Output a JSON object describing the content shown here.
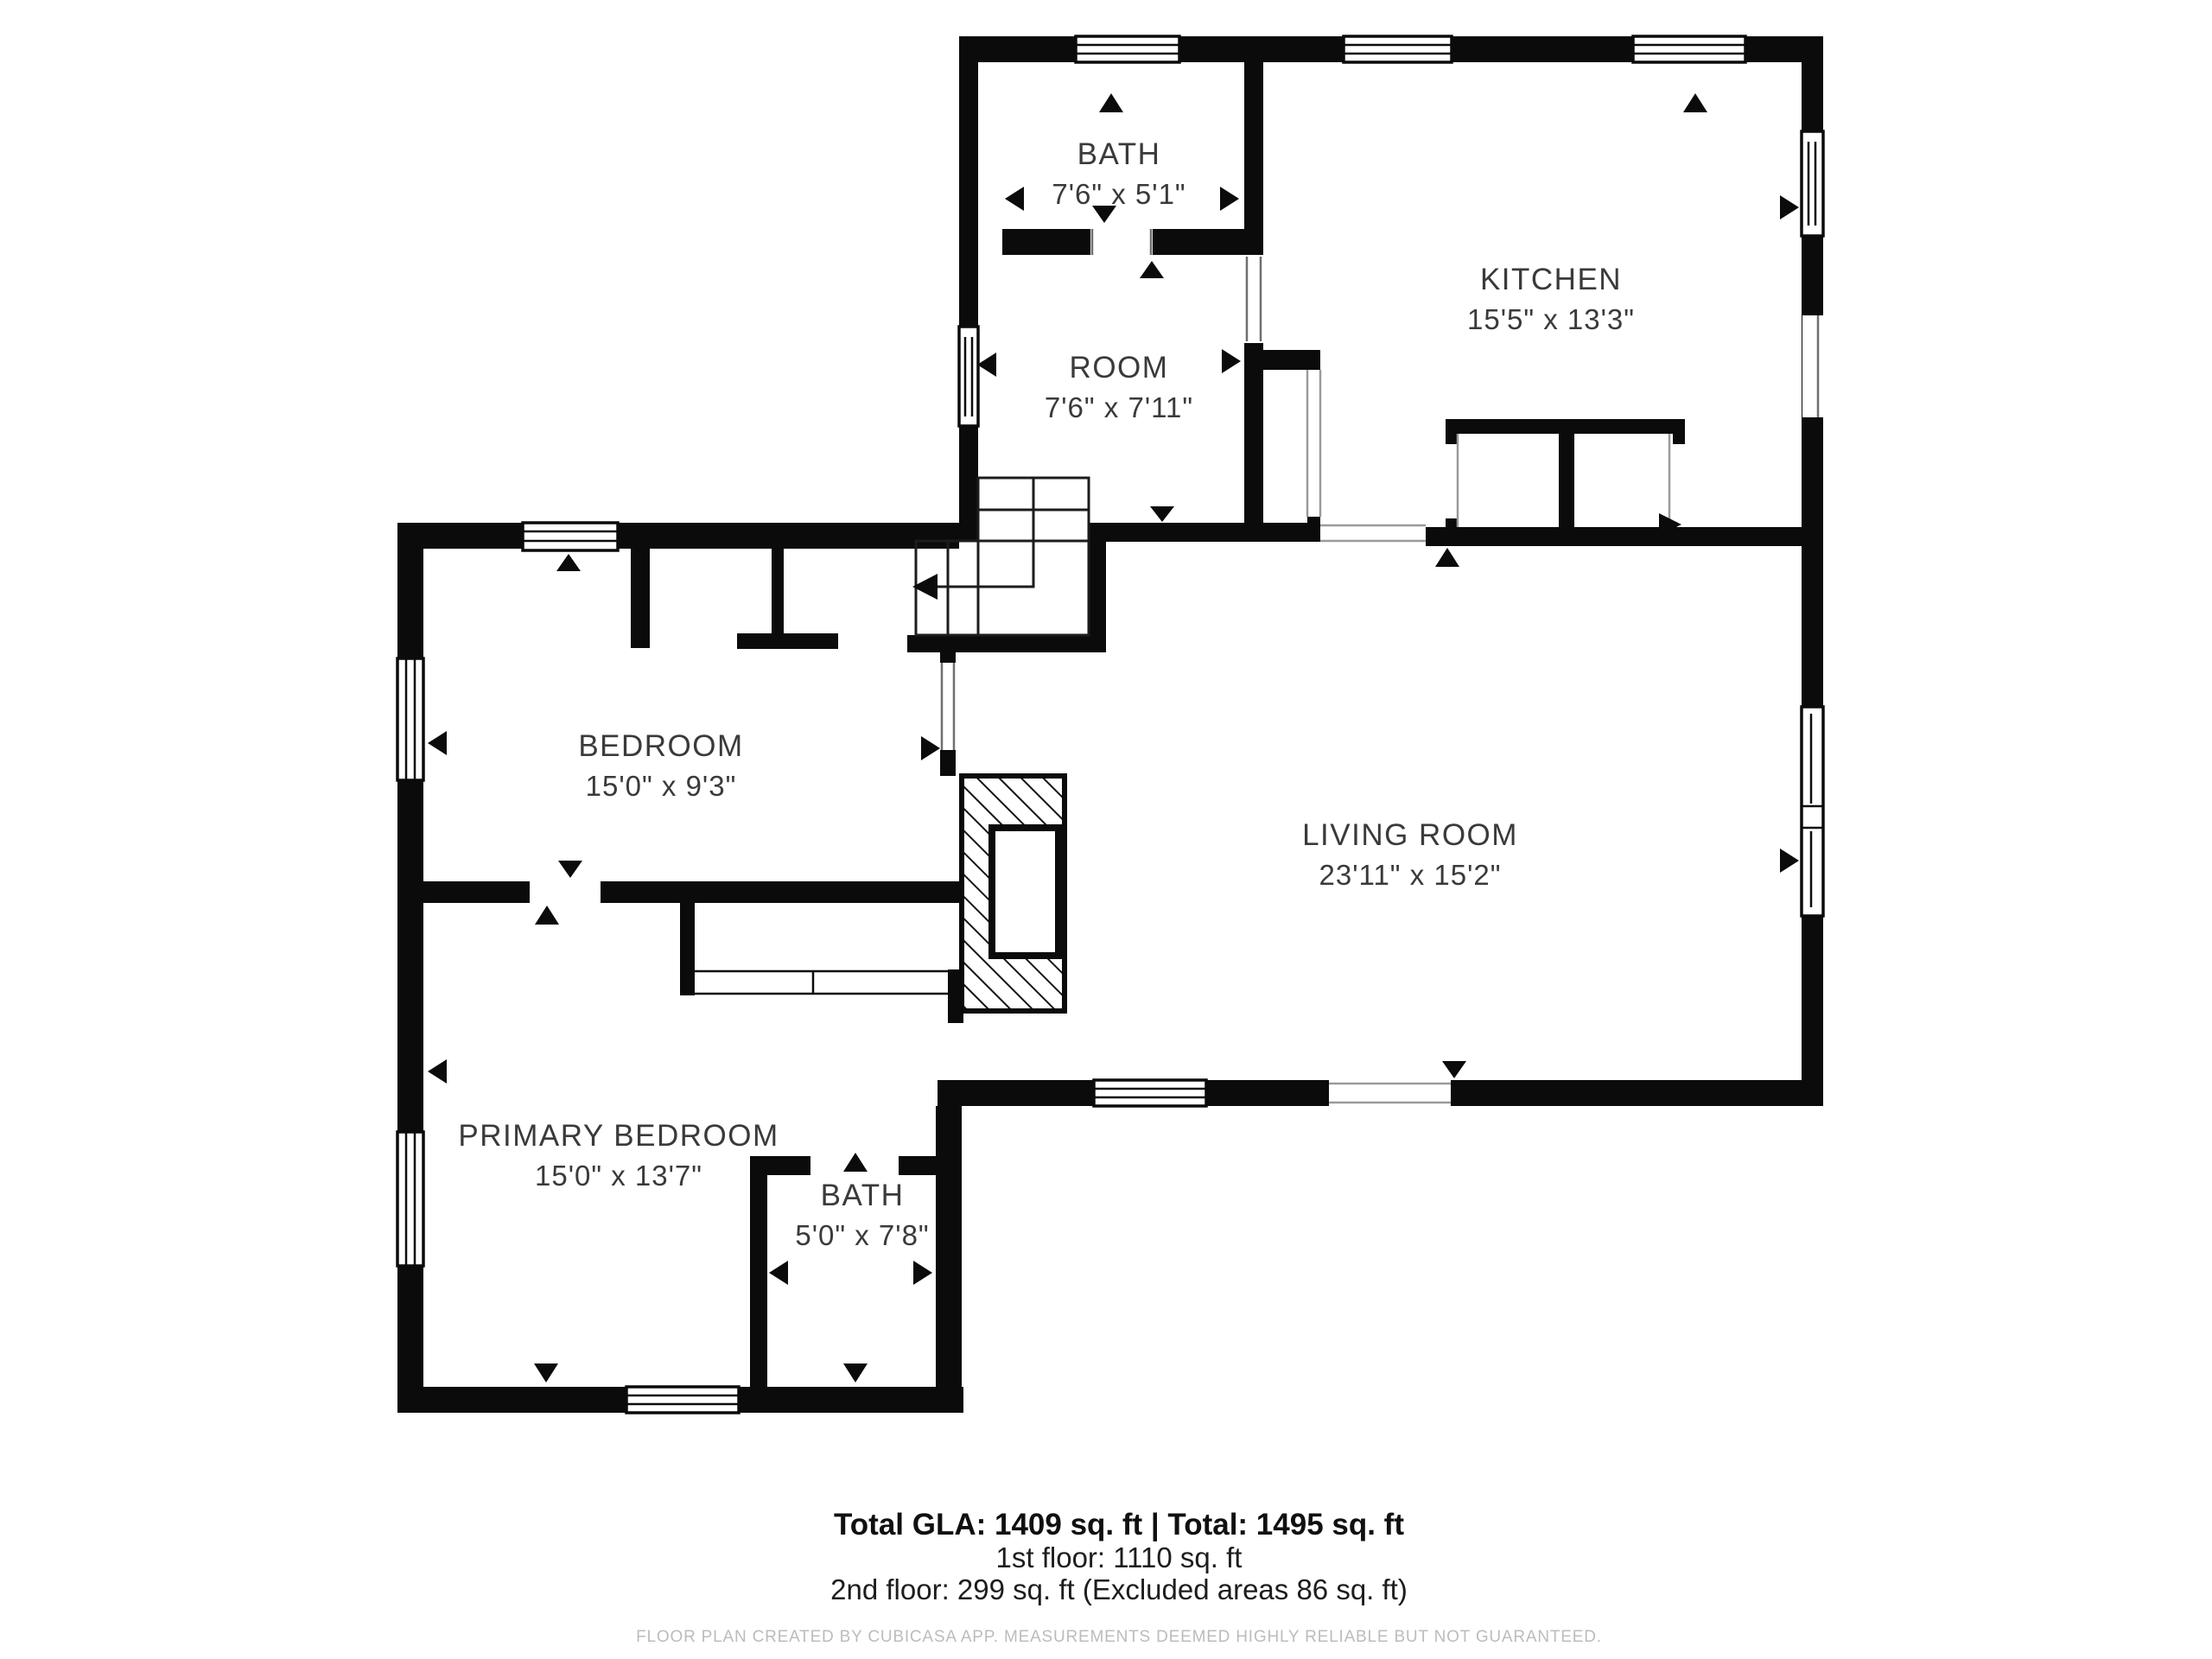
{
  "plan": {
    "colors": {
      "wall": "#0b0b0b",
      "background": "#ffffff",
      "label_text": "#3a3a3a",
      "footer_text": "#1d1d1d",
      "disclaimer_text": "#bcbcbc"
    },
    "rooms": {
      "bath_upper": {
        "name": "BATH",
        "dims": "7'6\" x 5'1\""
      },
      "kitchen": {
        "name": "KITCHEN",
        "dims": "15'5\" x 13'3\""
      },
      "room": {
        "name": "ROOM",
        "dims": "7'6\" x 7'11\""
      },
      "bedroom": {
        "name": "BEDROOM",
        "dims": "15'0\" x 9'3\""
      },
      "living_room": {
        "name": "LIVING ROOM",
        "dims": "23'11\" x 15'2\""
      },
      "primary_bedroom": {
        "name": "PRIMARY BEDROOM",
        "dims": "15'0\" x 13'7\""
      },
      "bath_lower": {
        "name": "BATH",
        "dims": "5'0\" x 7'8\""
      }
    }
  },
  "footer": {
    "totals": "Total GLA: 1409 sq. ft | Total: 1495 sq. ft",
    "first_floor": "1st floor: 1110 sq. ft",
    "second_floor": "2nd floor: 299 sq. ft (Excluded areas 86 sq. ft)",
    "disclaimer": "FLOOR PLAN CREATED BY CUBICASA APP. MEASUREMENTS DEEMED HIGHLY RELIABLE BUT NOT GUARANTEED."
  }
}
